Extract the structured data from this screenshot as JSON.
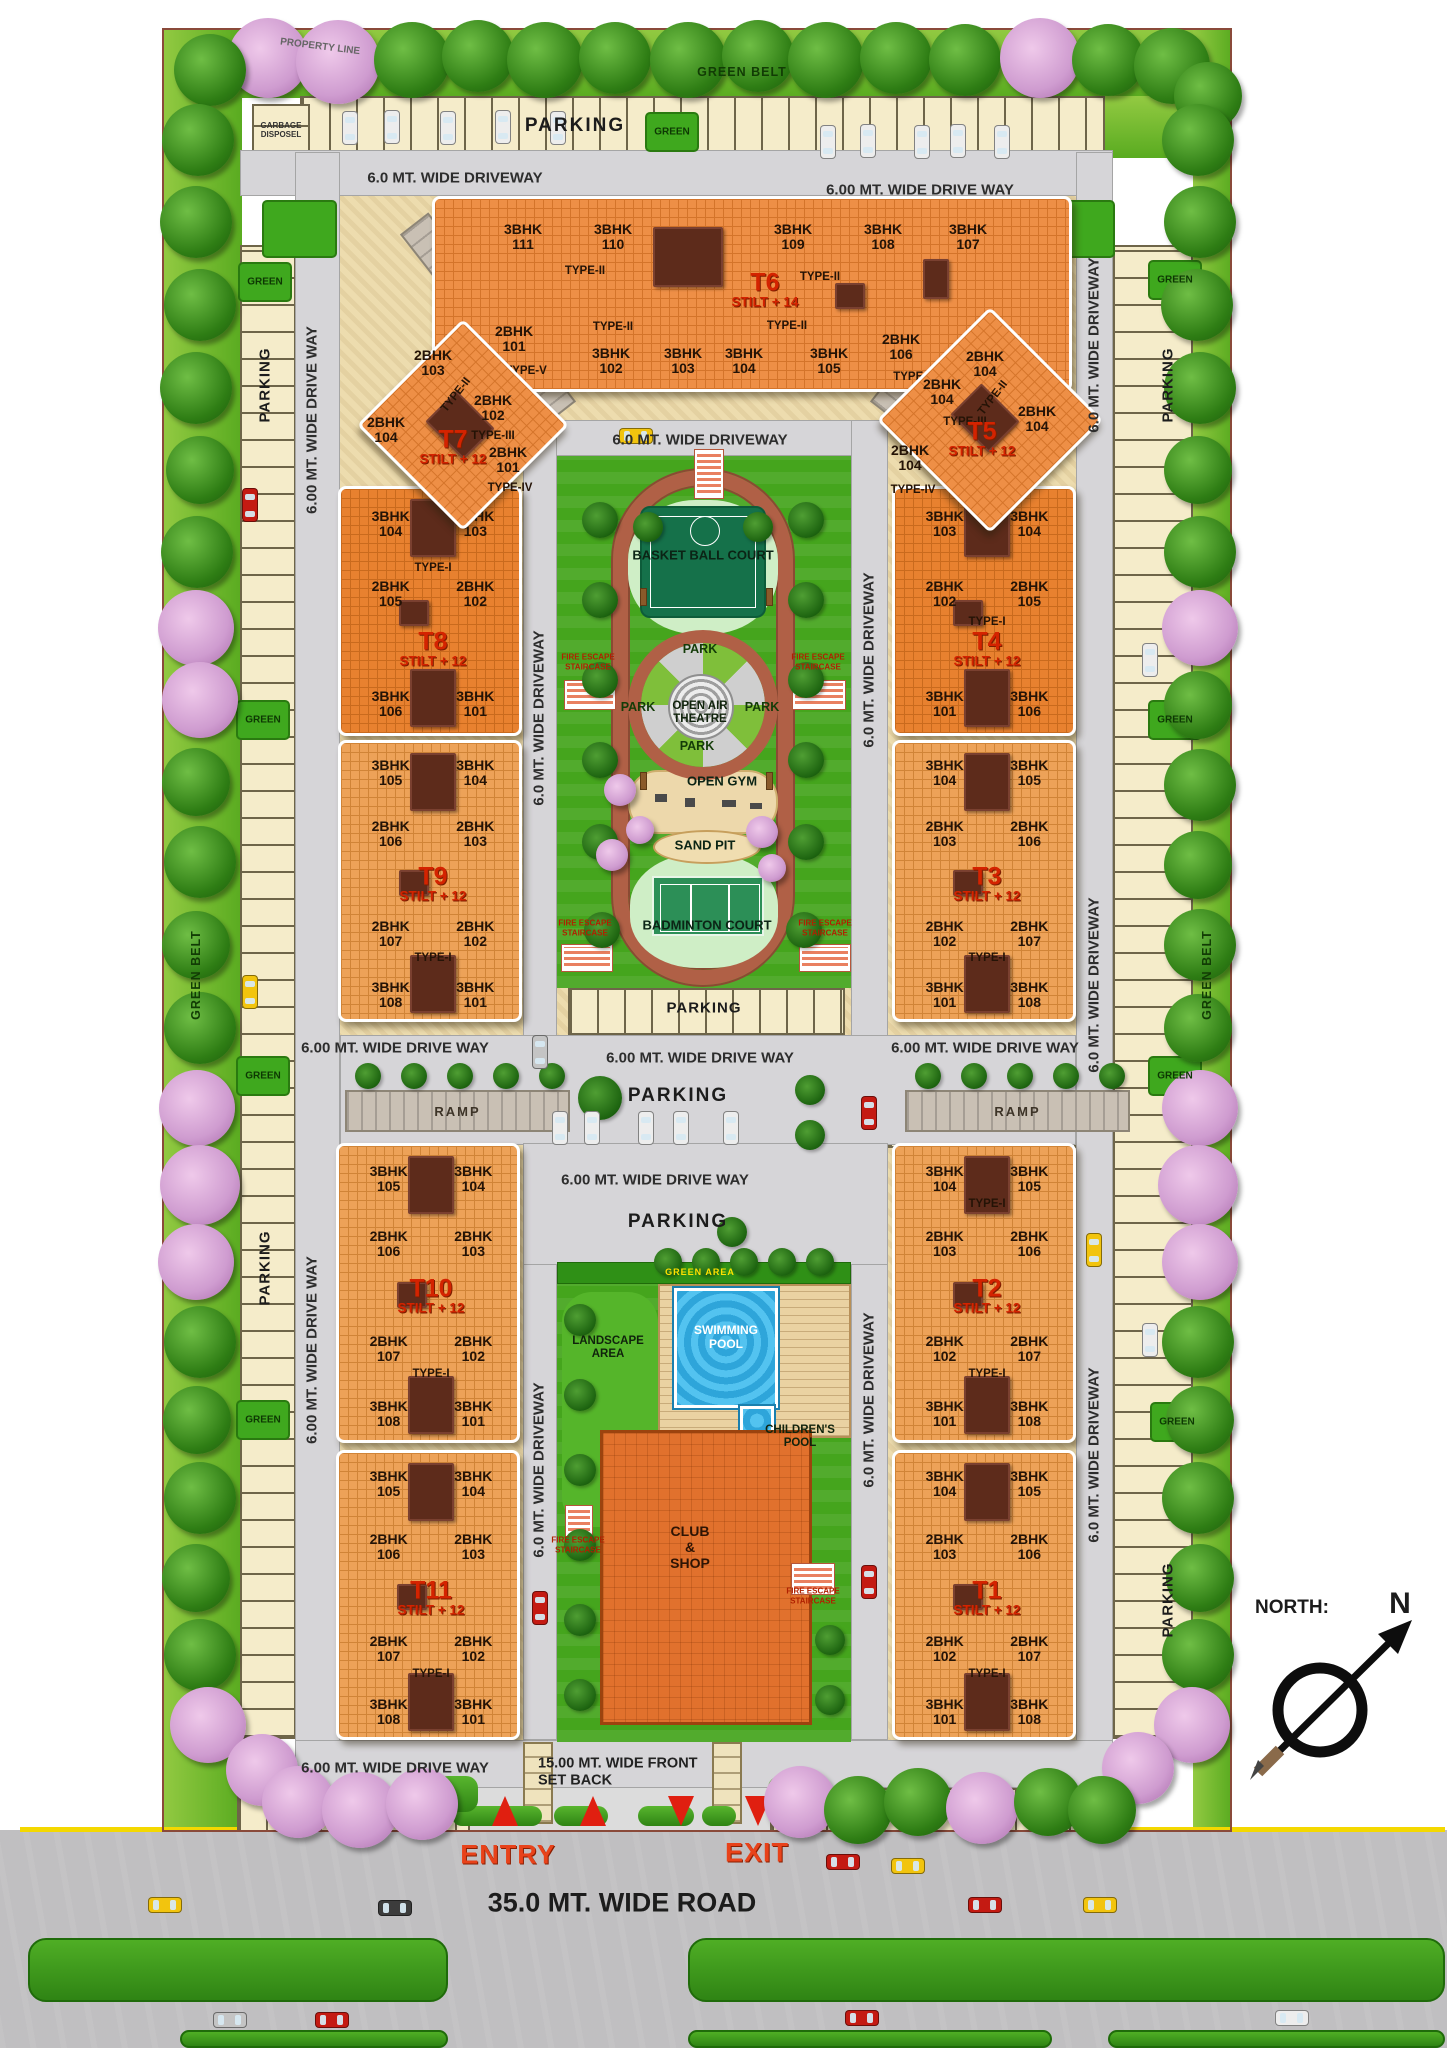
{
  "labels": {
    "green_belt": "GREEN BELT",
    "green": "GREEN",
    "parking": "PARKING",
    "garbage_disposal": "GARBAGE\nDISPOSEL",
    "property_line": "PROPERTY LINE",
    "ramp": "RAMP",
    "driveway_a": "6.0 MT. WIDE DRIVEWAY",
    "driveway_b": "6.00 MT.  WIDE DRIVE WAY",
    "basketball_court": "BASKET BALL COURT",
    "park": "PARK",
    "open_air_theatre": "OPEN AIR\nTHEATRE",
    "open_gym": "OPEN GYM",
    "sand_pit": "SAND PIT",
    "badminton_court": "BADMINTON COURT",
    "fire_escape_staircase": "FIRE ESCAPE STAIRCASE",
    "green_area": "GREEN AREA",
    "landscape_area": "LANDSCAPE\nAREA",
    "swimming_pool": "SWIMMING\nPOOL",
    "childrens_pool": "CHILDREN'S\nPOOL",
    "club_shop": "CLUB\n&\nSHOP",
    "front_setback": "15.00 MT. WIDE FRONT\nSET BACK",
    "entry": "ENTRY",
    "exit": "EXIT",
    "road_35": "35.0 MT. WIDE ROAD",
    "north": "NORTH:",
    "north_n": "N"
  },
  "towers": [
    {
      "id": "t6",
      "name": "T6",
      "stilt": "STILT + 14",
      "top_units": [
        "3BHK 111",
        "3BHK 110",
        "3BHK 109",
        "3BHK 108",
        "3BHK 107"
      ],
      "mid_types": [
        "TYPE-II",
        "TYPE-II",
        "TYPE-II",
        "TYPE-II"
      ],
      "bottom_units": [
        {
          "u": "2BHK 101",
          "t": "TYPE-V"
        },
        {
          "u": "3BHK 102"
        },
        {
          "u": "3BHK 103"
        },
        {
          "u": "3BHK 104"
        },
        {
          "u": "3BHK 105"
        },
        {
          "u": "2BHK 106",
          "t": "TYPE-V"
        }
      ]
    },
    {
      "id": "t7",
      "name": "T7",
      "stilt": "STILT + 12",
      "units": [
        {
          "u": "2BHK 103",
          "t": "TYPE-II"
        },
        {
          "u": "2BHK 102",
          "t": "TYPE-III"
        },
        {
          "u": "2BHK 104"
        },
        {
          "u": "2BHK 101",
          "t": "TYPE-IV"
        }
      ]
    },
    {
      "id": "t5",
      "name": "T5",
      "stilt": "STILT + 12",
      "units": [
        {
          "u": "2BHK 104",
          "t": "TYPE-II"
        },
        {
          "u": "2BHK 104",
          "t": "TYPE-III"
        },
        {
          "u": "2BHK 104"
        },
        {
          "u": "2BHK 104",
          "t": "TYPE-IV"
        }
      ]
    },
    {
      "id": "t8",
      "name": "T8",
      "stilt": "STILT + 12",
      "type": "TYPE-I",
      "rows": [
        [
          "3BHK 104",
          "3BHK 103"
        ],
        [
          "2BHK 105",
          "2BHK 102"
        ],
        [
          "3BHK 106",
          "3BHK 101"
        ]
      ]
    },
    {
      "id": "t9",
      "name": "T9",
      "stilt": "STILT + 12",
      "type": "TYPE-I",
      "rows": [
        [
          "3BHK 105",
          "3BHK 104"
        ],
        [
          "2BHK 106",
          "2BHK 103"
        ],
        [
          "2BHK 107",
          "2BHK 102"
        ],
        [
          "3BHK 108",
          "3BHK 101"
        ]
      ]
    },
    {
      "id": "t4",
      "name": "T4",
      "stilt": "STILT + 12",
      "type": "TYPE-I",
      "rows": [
        [
          "3BHK 103",
          "3BHK 104"
        ],
        [
          "2BHK 102",
          "2BHK 105"
        ],
        [
          "3BHK 101",
          "3BHK 106"
        ]
      ]
    },
    {
      "id": "t3",
      "name": "T3",
      "stilt": "STILT + 12",
      "type": "TYPE-I",
      "rows": [
        [
          "3BHK 104",
          "3BHK 105"
        ],
        [
          "2BHK 103",
          "2BHK 106"
        ],
        [
          "2BHK 102",
          "2BHK 107"
        ],
        [
          "3BHK 101",
          "3BHK 108"
        ]
      ]
    },
    {
      "id": "t10",
      "name": "T10",
      "stilt": "STILT + 12",
      "type": "TYPE-I",
      "rows": [
        [
          "3BHK 105",
          "3BHK 104"
        ],
        [
          "2BHK 106",
          "2BHK 103"
        ],
        [
          "2BHK 107",
          "2BHK 102"
        ],
        [
          "3BHK 108",
          "3BHK 101"
        ]
      ]
    },
    {
      "id": "t11",
      "name": "T11",
      "stilt": "STILT + 12",
      "type": "TYPE-I",
      "rows": [
        [
          "3BHK 105",
          "3BHK 104"
        ],
        [
          "2BHK 106",
          "2BHK 103"
        ],
        [
          "2BHK 107",
          "2BHK 102"
        ],
        [
          "3BHK 108",
          "3BHK 101"
        ]
      ]
    },
    {
      "id": "t2",
      "name": "T2",
      "stilt": "STILT + 12",
      "type": "TYPE-I",
      "rows": [
        [
          "3BHK 104",
          "3BHK 105"
        ],
        [
          "2BHK 103",
          "2BHK 106"
        ],
        [
          "2BHK 102",
          "2BHK 107"
        ],
        [
          "3BHK 101",
          "3BHK 108"
        ]
      ]
    },
    {
      "id": "t1",
      "name": "T1",
      "stilt": "STILT + 12",
      "type": "TYPE-I",
      "rows": [
        [
          "3BHK 104",
          "3BHK 105"
        ],
        [
          "2BHK 103",
          "2BHK 106"
        ],
        [
          "2BHK 102",
          "2BHK 107"
        ],
        [
          "3BHK 101",
          "3BHK 108"
        ]
      ]
    }
  ]
}
